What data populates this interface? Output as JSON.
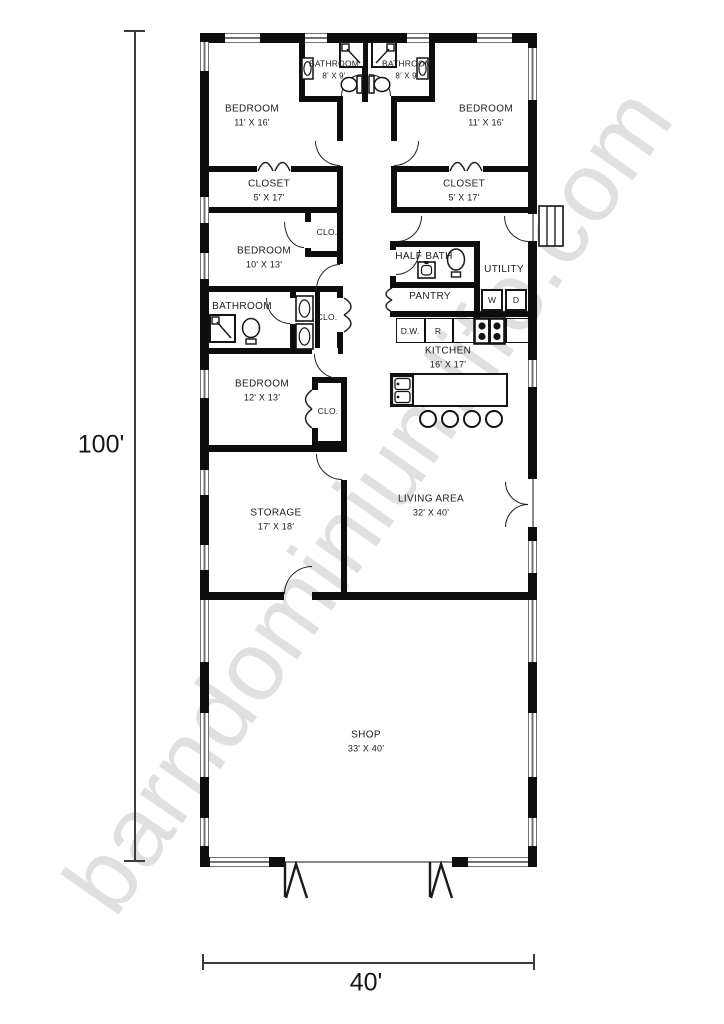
{
  "watermark": "barndominiumlife.com",
  "dimensions": {
    "overall_height": "100'",
    "overall_width": "40'"
  },
  "rooms": {
    "bedroom_top_left": {
      "name": "BEDROOM",
      "dims": "11' X 16'"
    },
    "bathroom_top_left": {
      "name": "BATHROOM",
      "dims": "8' X 9'"
    },
    "bathroom_top_right": {
      "name": "BATHROOM",
      "dims": "8' X 9'"
    },
    "bedroom_top_right": {
      "name": "BEDROOM",
      "dims": "11' X 16'"
    },
    "closet_left": {
      "name": "CLOSET",
      "dims": "5' X 17'"
    },
    "closet_right": {
      "name": "CLOSET",
      "dims": "5' X 17'"
    },
    "bedroom_middle": {
      "name": "BEDROOM",
      "dims": "10' X 13'"
    },
    "closet_small_top": {
      "name": "CLO."
    },
    "bathroom_middle": {
      "name": "BATHROOM"
    },
    "closet_small_mid": {
      "name": "CLO."
    },
    "half_bath": {
      "name": "HALF BATH"
    },
    "utility": {
      "name": "UTILITY"
    },
    "pantry": {
      "name": "PANTRY"
    },
    "kitchen": {
      "name": "KITCHEN",
      "dims": "16' X 17'"
    },
    "bedroom_lower": {
      "name": "BEDROOM",
      "dims": "12' X 13'"
    },
    "closet_small_lower": {
      "name": "CLO."
    },
    "storage": {
      "name": "STORAGE",
      "dims": "17' X 18'"
    },
    "living_area": {
      "name": "LIVING AREA",
      "dims": "32' X 40'"
    },
    "shop": {
      "name": "SHOP",
      "dims": "33' X 40'"
    }
  },
  "appliances": {
    "washer": "W",
    "dryer": "D",
    "dishwasher": "D.W.",
    "range": "R"
  },
  "colors": {
    "wall": "#0d0d0d",
    "window_line": "#737373",
    "watermark": "#c7c7c7"
  }
}
